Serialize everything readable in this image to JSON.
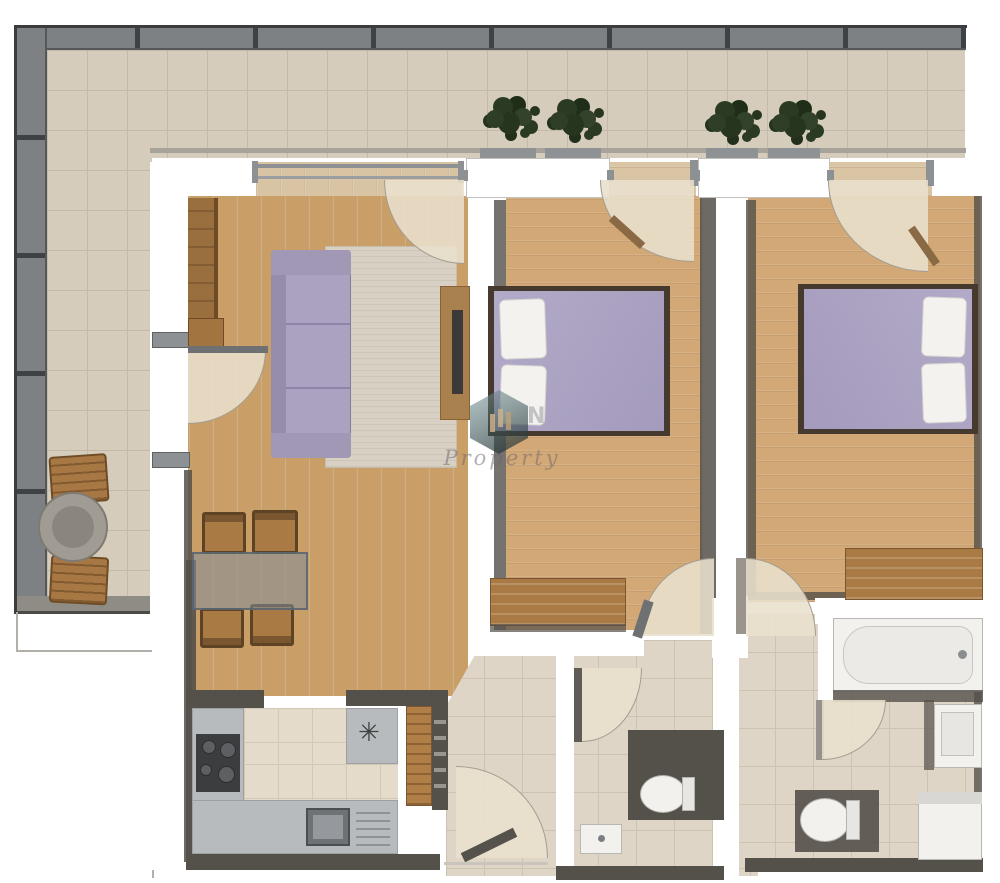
{
  "title": "apartment-floor-plan-render",
  "watermark": {
    "text": "Property",
    "fragment": "N",
    "logo": "hexagon-buildings-logo"
  },
  "icons": {
    "ceiling_fan": "✳"
  },
  "palette": {
    "wood_living": "#c99e67",
    "wood_bedroom": "#d2a876",
    "tile_balcony": "#d5ccbc",
    "tile_indoor": "#ded5c6",
    "tile_grid": "#cdc3b2",
    "wall_white": "#ffffff",
    "wall_shadow": "#54504a",
    "railing": "#7d8184",
    "upholstery_lavender": "#aba2c1",
    "bed_frame": "#46392e",
    "furniture_wood": "#a97a43",
    "counter": "#b8bbbd",
    "cooktop": "#3b3d3f",
    "fixture": "#f2f1ee"
  },
  "rooms": [
    {
      "name": "balcony",
      "furniture": [
        "round-table",
        "chair",
        "chair",
        "planters-with-plants"
      ]
    },
    {
      "name": "living-room",
      "furniture": [
        "wardrobe",
        "sofa",
        "rug",
        "tv-stand",
        "dining-table",
        "four-chairs",
        "balcony-door"
      ]
    },
    {
      "name": "kitchen",
      "furniture": [
        "cooktop",
        "sink",
        "drainer",
        "u-shaped-counter",
        "shelf-cabinet",
        "ceiling-fan"
      ]
    },
    {
      "name": "bedroom-1",
      "furniture": [
        "double-bed",
        "two-pillows",
        "dresser",
        "balcony-door",
        "hall-door"
      ]
    },
    {
      "name": "bedroom-2",
      "furniture": [
        "double-bed",
        "two-pillows",
        "dresser",
        "balcony-door",
        "hall-door"
      ]
    },
    {
      "name": "hallway",
      "furniture": [
        "radiator",
        "entrance-door"
      ]
    },
    {
      "name": "wc",
      "furniture": [
        "toilet",
        "washbasin"
      ]
    },
    {
      "name": "bathroom",
      "furniture": [
        "bathtub",
        "washbasin",
        "toilet",
        "washing-machine"
      ]
    }
  ]
}
